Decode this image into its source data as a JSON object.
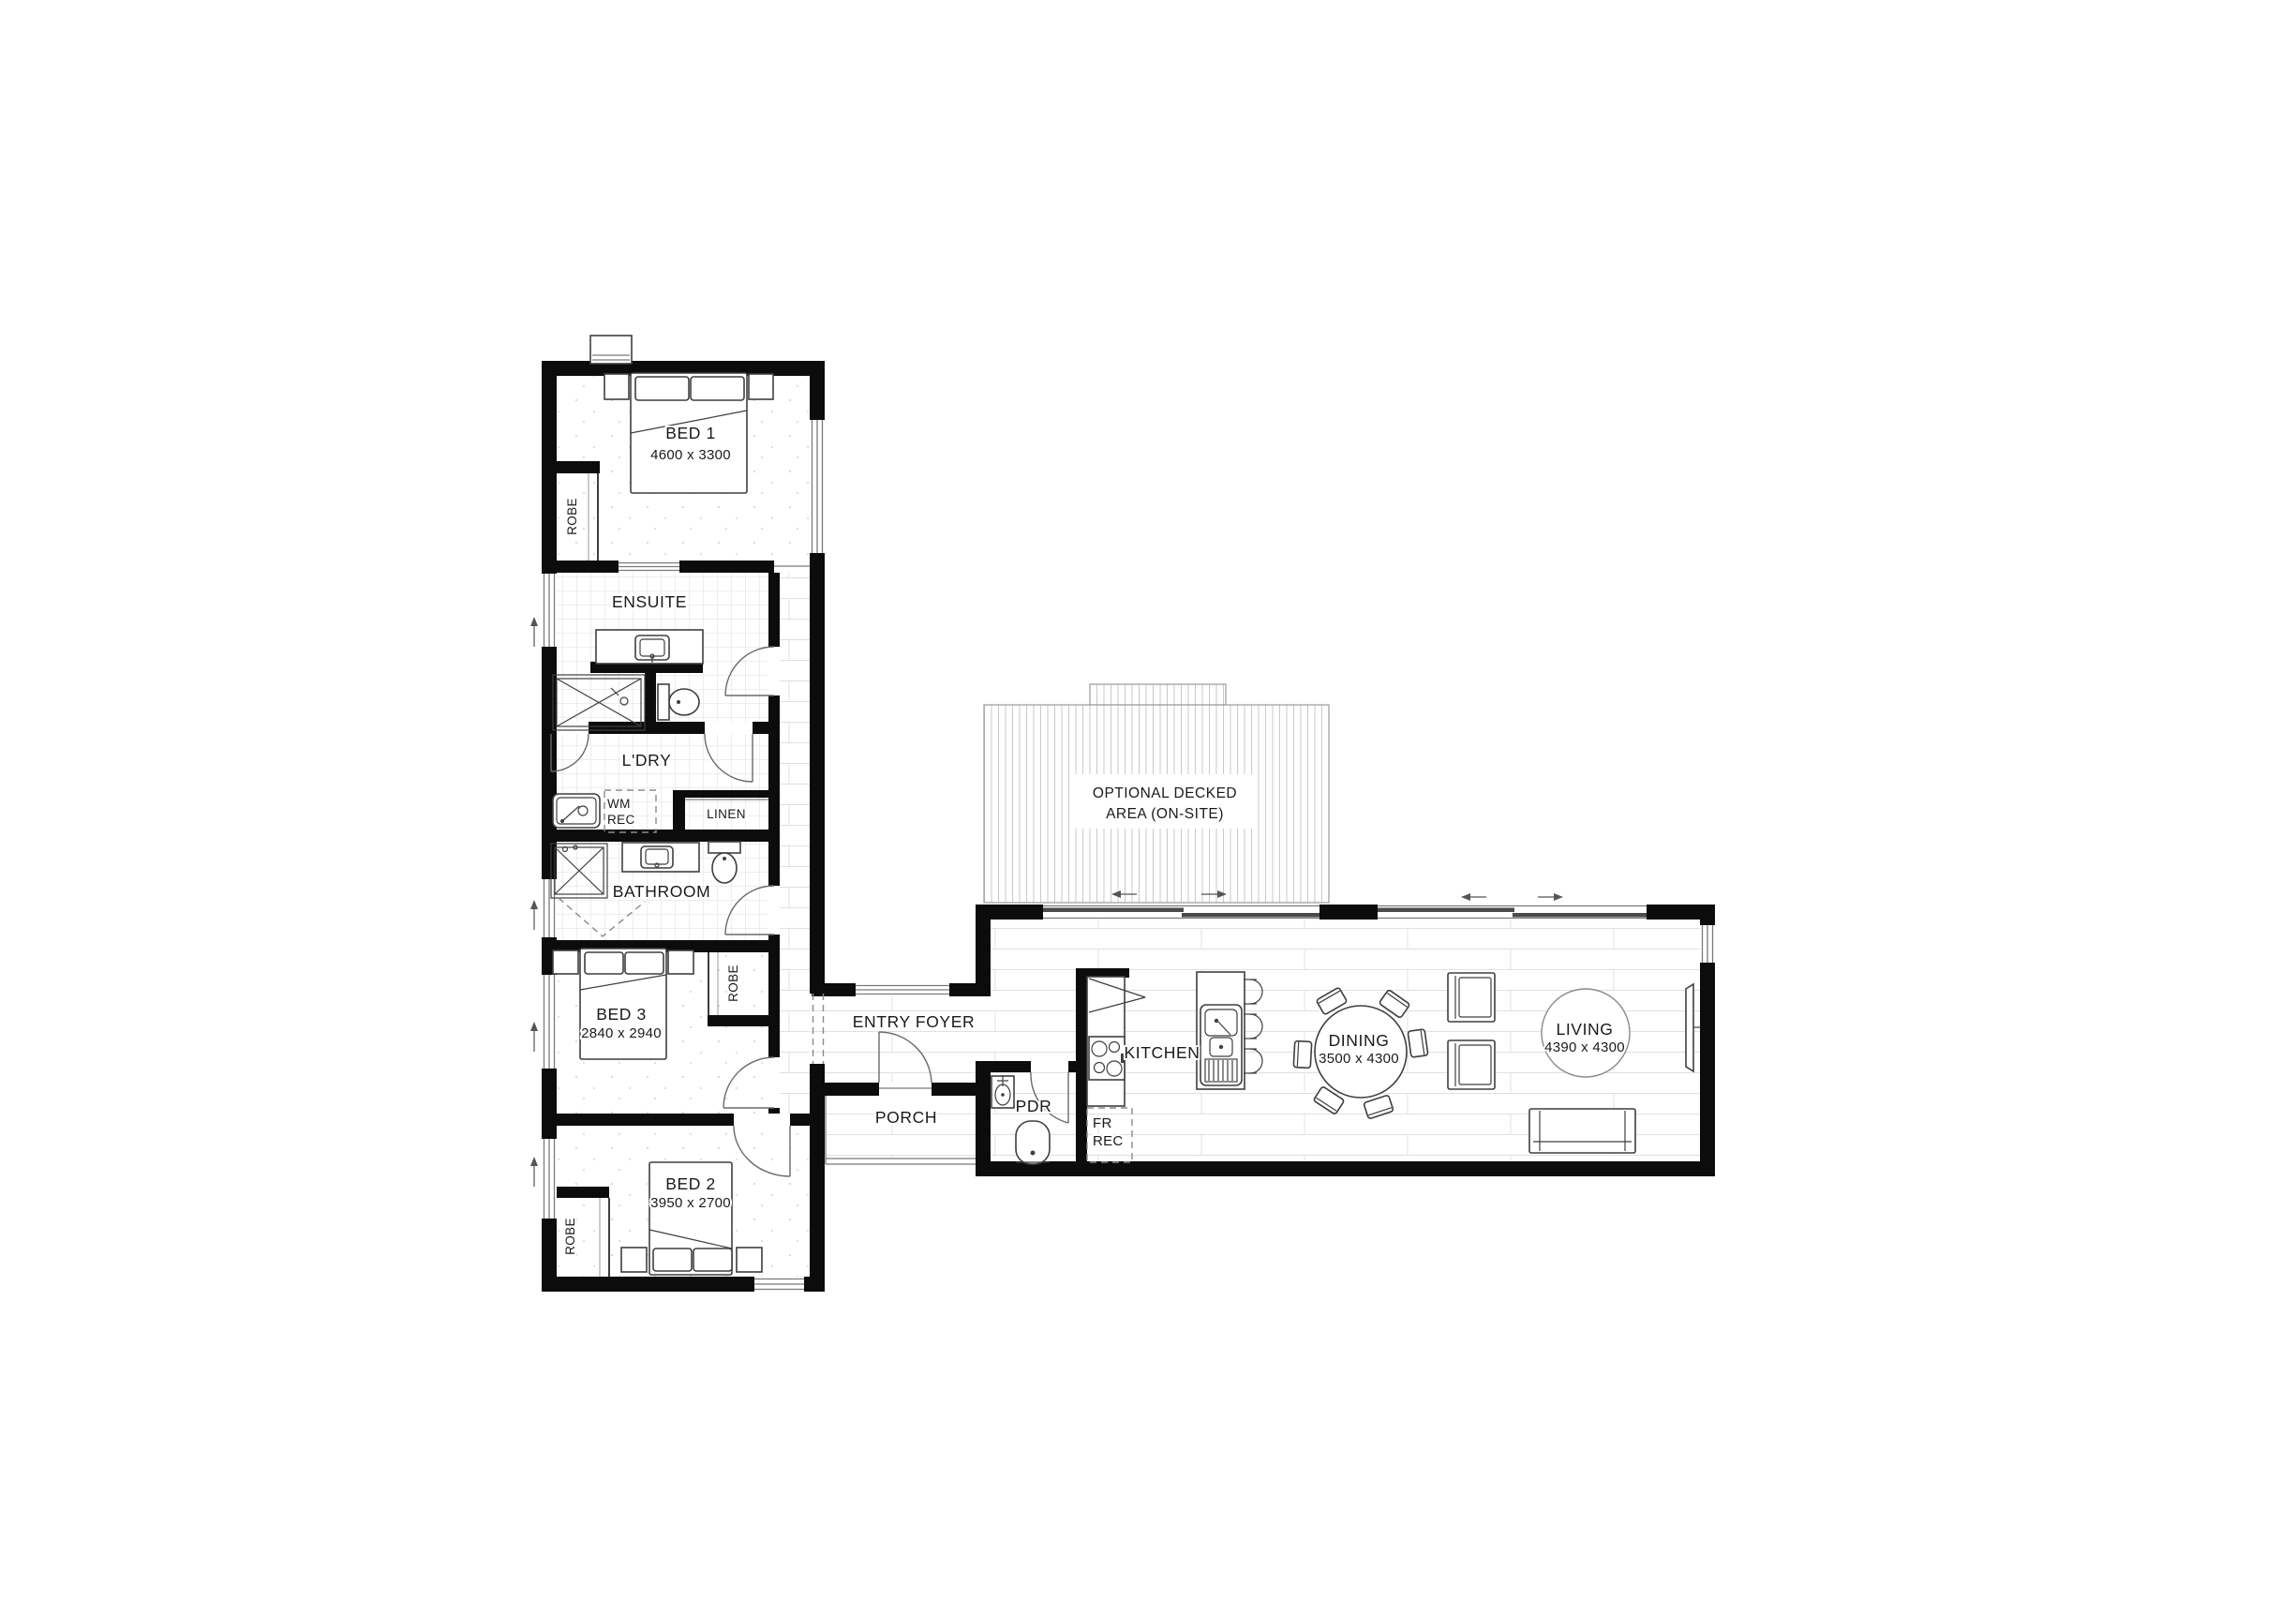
{
  "plan": {
    "rooms": {
      "bed1": {
        "name": "BED 1",
        "dims": "4600 x 3300"
      },
      "ensuite": {
        "name": "ENSUITE"
      },
      "robe": {
        "name": "ROBE"
      },
      "ldry": {
        "name": "L'DRY"
      },
      "wm_rec": {
        "line1": "WM",
        "line2": "REC"
      },
      "linen": {
        "name": "LINEN"
      },
      "bathroom": {
        "name": "BATHROOM"
      },
      "bed3": {
        "name": "BED 3",
        "dims": "2840 x 2940"
      },
      "bed2": {
        "name": "BED 2",
        "dims": "3950 x 2700"
      },
      "entry_foyer": {
        "name": "ENTRY FOYER"
      },
      "porch": {
        "name": "PORCH"
      },
      "pdr": {
        "name": "PDR"
      },
      "fr_rec": {
        "line1": "FR",
        "line2": "REC"
      },
      "kitchen": {
        "name": "KITCHEN"
      },
      "dining": {
        "name": "DINING",
        "dims": "3500 x 4300"
      },
      "living": {
        "name": "LIVING",
        "dims": "4390 x 4300"
      },
      "deck": {
        "line1": "OPTIONAL DECKED",
        "line2": "AREA (ON-SITE)"
      }
    },
    "colors": {
      "wall": "#0c0c0c",
      "fixture_line": "#3f3f3f",
      "floor_line": "#dfdfdf",
      "text": "#1a1a1a"
    }
  }
}
